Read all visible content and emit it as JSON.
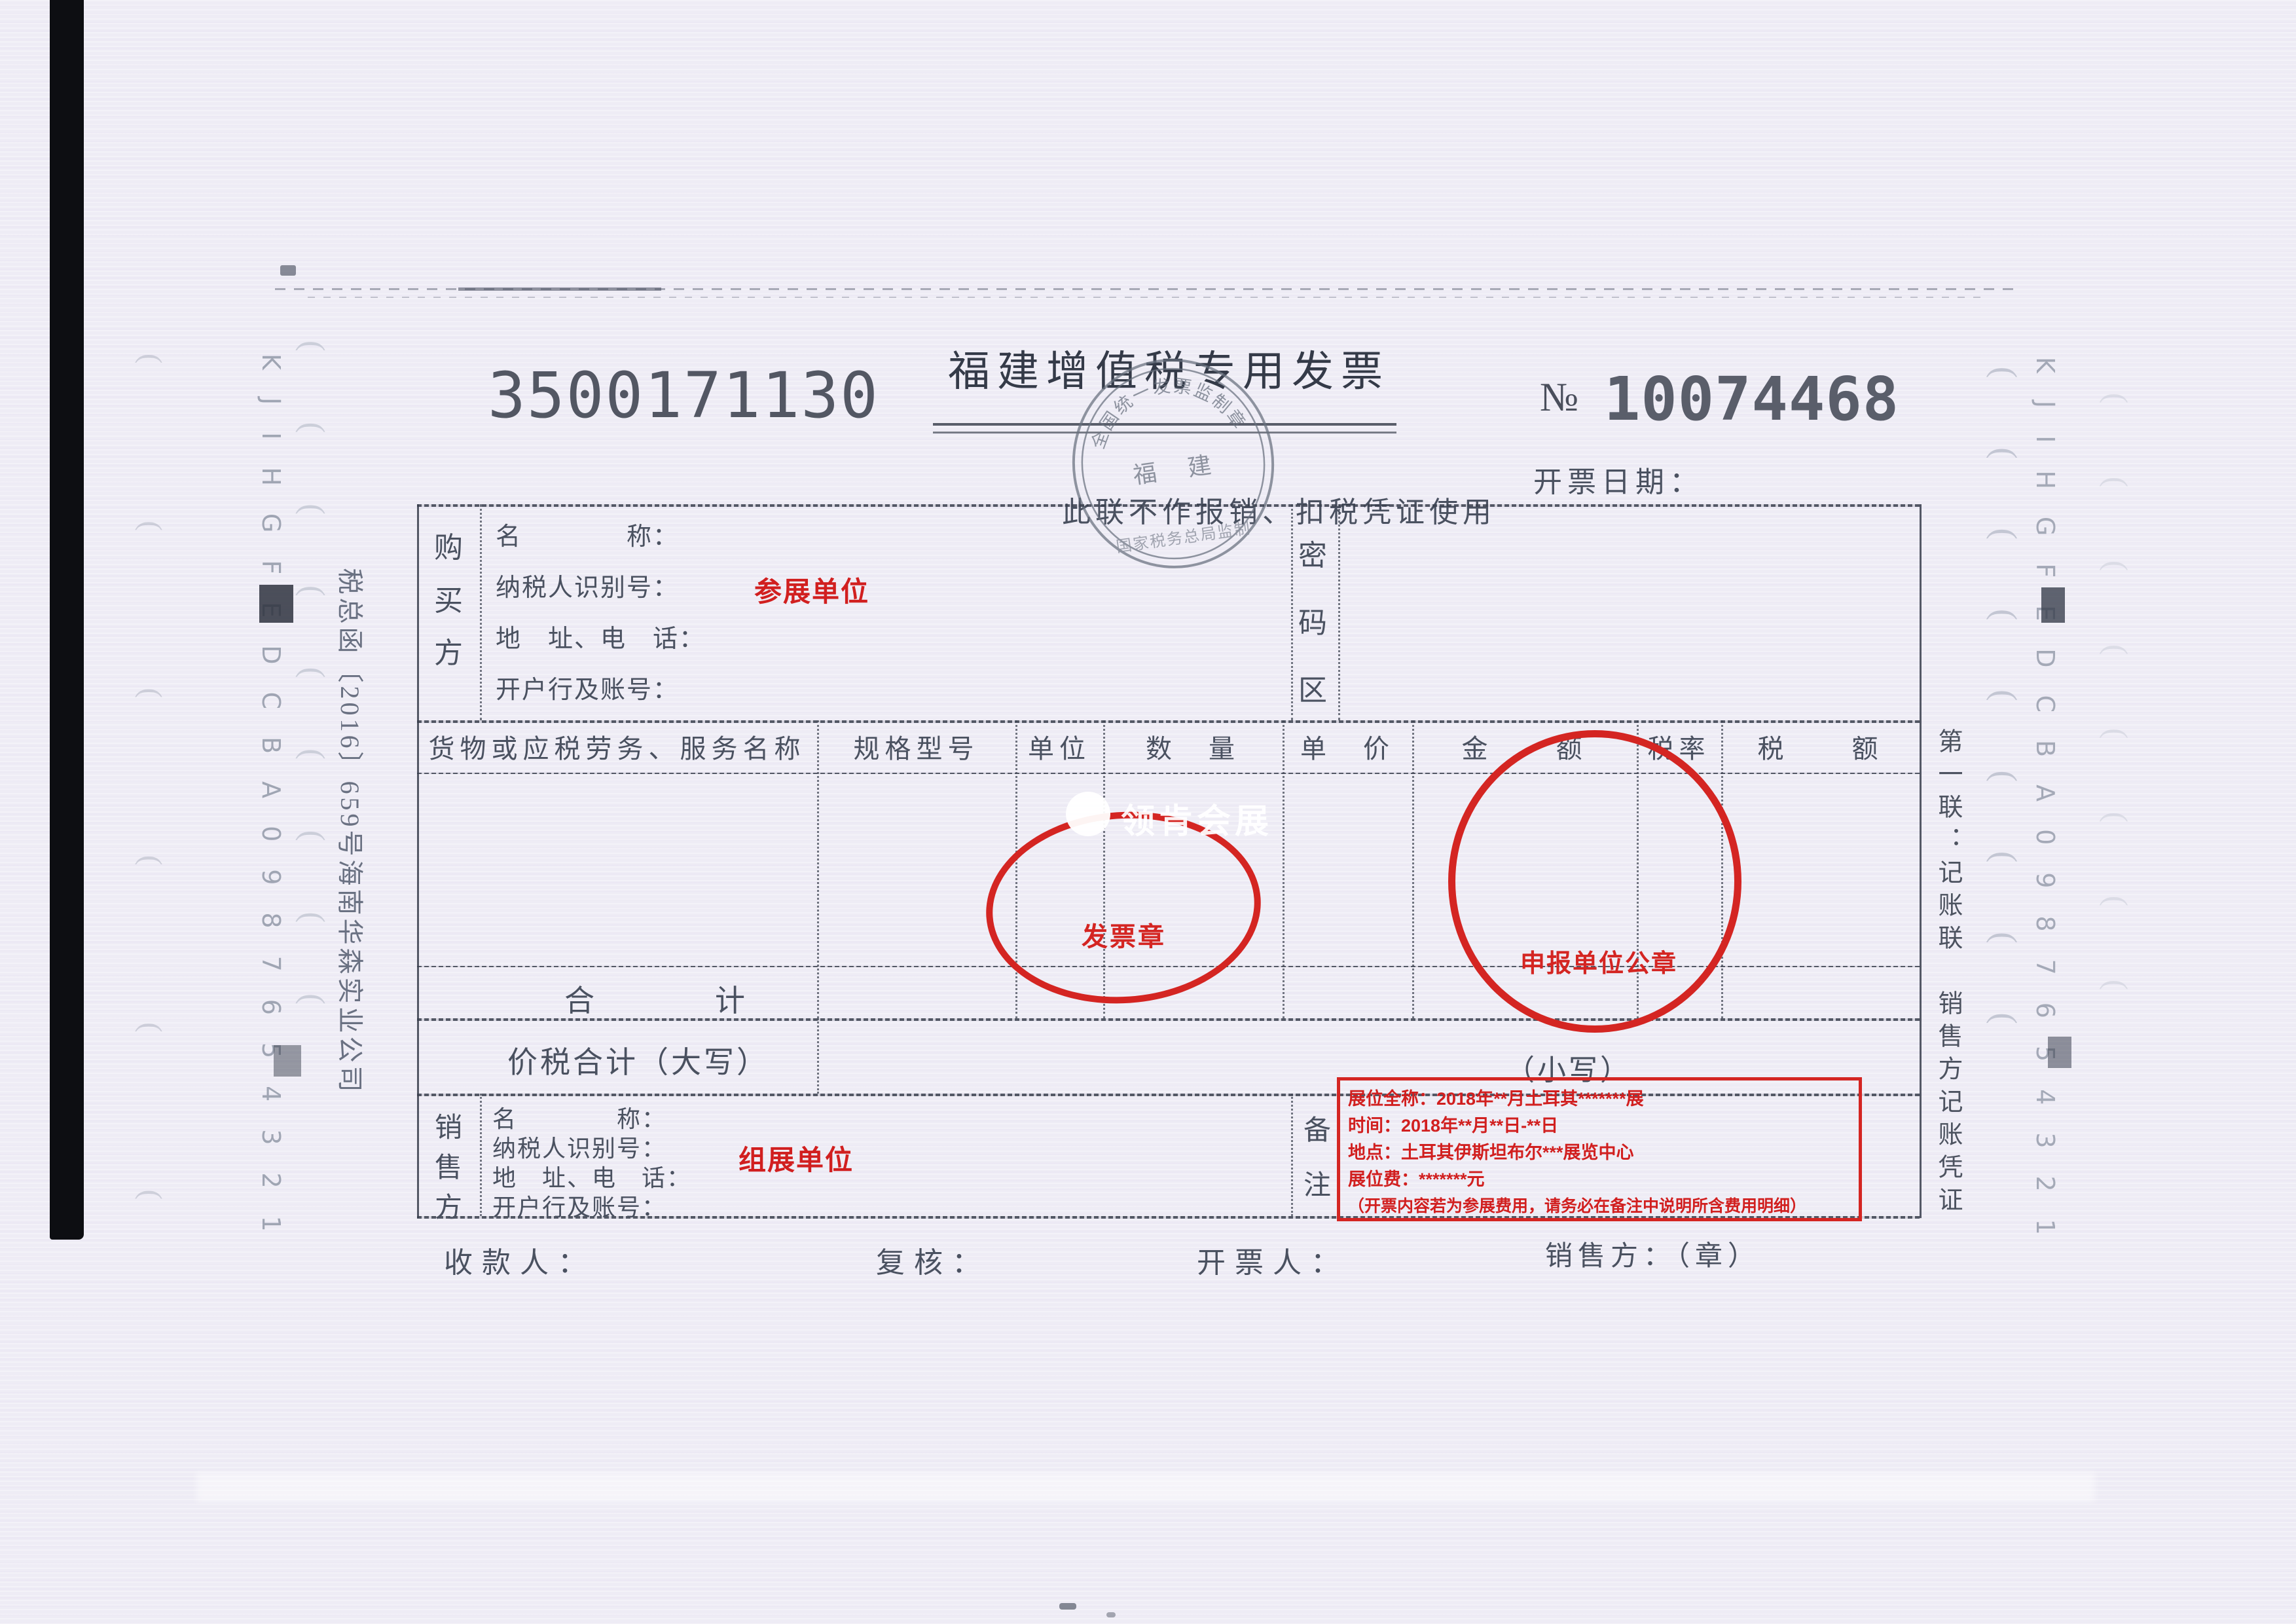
{
  "colors": {
    "accent_red": "#d11f1f",
    "ink": "#4a5160",
    "stamp_gray": "#68707e"
  },
  "header": {
    "code": "3500171130",
    "title": "福建增值税专用发票",
    "subtitle": "此联不作报销、扣税凭证使用",
    "number_prefix": "№",
    "number": "10074468",
    "date_label": "开票日期："
  },
  "stamp": {
    "top_arc": "全国统一发票监制章",
    "center": "福　建",
    "bottom_arc": "国家税务总局监制"
  },
  "watermark": {
    "text": "领肯会展"
  },
  "buyer": {
    "party": [
      "购",
      "买",
      "方"
    ],
    "fields": [
      "名　　　　称：",
      "纳税人识别号：",
      "地　址、电　话：",
      "开户行及账号："
    ],
    "annotation": "参展单位",
    "password": [
      "密",
      "码",
      "区"
    ]
  },
  "items": {
    "headers": [
      "货物或应税劳务、服务名称",
      "规格型号",
      "单位",
      "数　量",
      "单　价",
      "金　　额",
      "税率",
      "税　　额"
    ],
    "total_label": "合　　　　计",
    "tax_total_label": "价税合计（大写）",
    "small_label": "（小写）"
  },
  "seals": {
    "invoice_seal": "发票章",
    "declaration_seal": "申报单位公章"
  },
  "seller": {
    "party": [
      "销",
      "售",
      "方"
    ],
    "fields": [
      "名　　　　称：",
      "纳税人识别号：",
      "地　址、电　话：",
      "开户行及账号："
    ],
    "annotation": "组展单位",
    "remark_label": [
      "备",
      "注"
    ]
  },
  "remarks": {
    "lines": [
      "展位全称：2018年**月土耳其*******展",
      "时间：2018年**月**日-**日",
      "地点：土耳其伊斯坦布尔***展览中心",
      "展位费：*******元",
      "（开票内容若为参展费用，请务必在备注中说明所含费用明细）"
    ]
  },
  "footer": {
    "payee": "收款人：",
    "reviewer": "复核：",
    "drawer": "开票人：",
    "seller_seal": "销售方：（章）"
  },
  "side": {
    "left_note": "税总函〔2016〕659号海南华森实业公司",
    "copy_text": "第一联：记账联　销售方记账凭证",
    "scale": "KJIHGFEDCBA0987654321"
  }
}
